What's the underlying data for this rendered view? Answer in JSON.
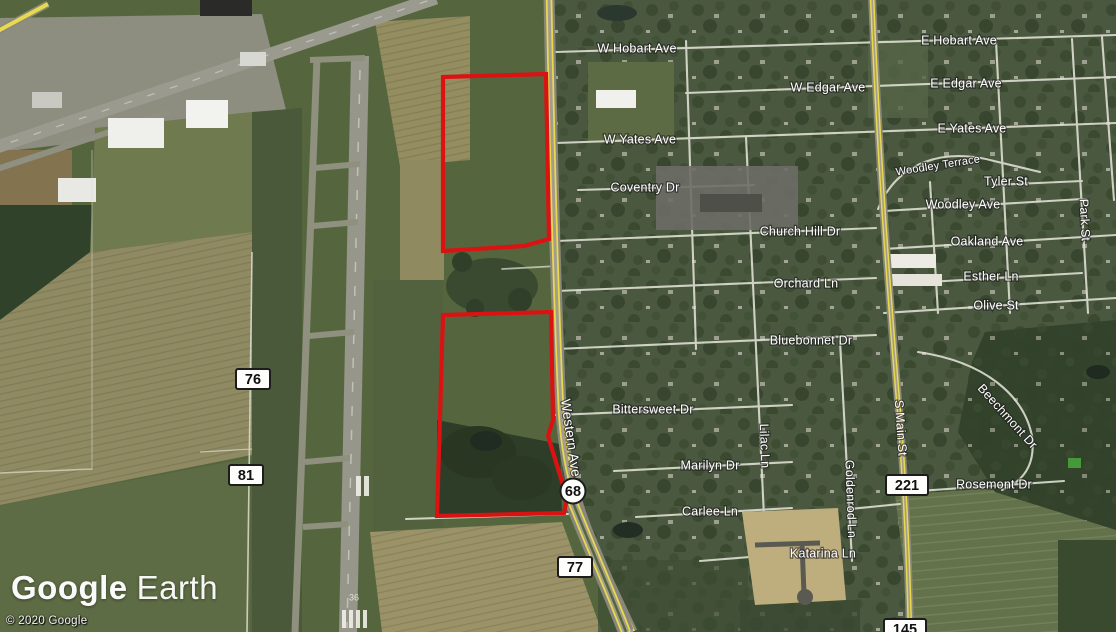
{
  "branding": {
    "logo_part1": "Google",
    "logo_part2": "Earth",
    "copyright": "© 2020 Google"
  },
  "street_labels": [
    {
      "name": "W Hobart Ave"
    },
    {
      "name": "E Hobart Ave"
    },
    {
      "name": "W Edgar Ave"
    },
    {
      "name": "E Edgar Ave"
    },
    {
      "name": "W Yates Ave"
    },
    {
      "name": "E Yates Ave"
    },
    {
      "name": "Coventry Dr"
    },
    {
      "name": "Woodley Terrace"
    },
    {
      "name": "Tyler St"
    },
    {
      "name": "Woodley Ave"
    },
    {
      "name": "Church Hill Dr"
    },
    {
      "name": "Oakland Ave"
    },
    {
      "name": "Orchard Ln"
    },
    {
      "name": "Esther Ln"
    },
    {
      "name": "Olive St"
    },
    {
      "name": "Park St"
    },
    {
      "name": "Bluebonnet Dr"
    },
    {
      "name": "Bittersweet Dr"
    },
    {
      "name": "Western Ave"
    },
    {
      "name": "Marilyn Dr"
    },
    {
      "name": "Lilac Ln"
    },
    {
      "name": "Goldenrod Ln"
    },
    {
      "name": "Carlee Ln"
    },
    {
      "name": "Katarina Ln"
    },
    {
      "name": "S Main St"
    },
    {
      "name": "Beechmont Dr"
    },
    {
      "name": "Rosemont Dr"
    }
  ],
  "route_shields": [
    {
      "number": "76"
    },
    {
      "number": "81"
    },
    {
      "number": "68"
    },
    {
      "number": "77"
    },
    {
      "number": "221"
    },
    {
      "number": "145"
    }
  ],
  "runway": {
    "number": "36"
  },
  "colors": {
    "parcel_outline": "#db1212",
    "highway_yellow": "#e8d94f",
    "field_green": "#55663f"
  }
}
